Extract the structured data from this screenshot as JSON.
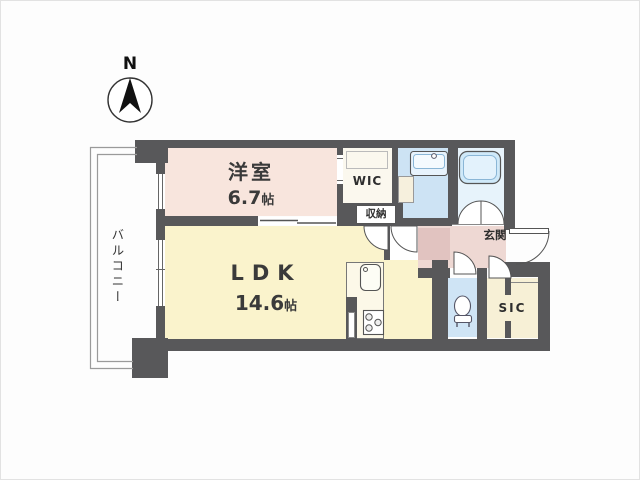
{
  "meta": {
    "document_type": "apartment floor plan",
    "compass_label": "N"
  },
  "rooms": {
    "yoshitsu": {
      "name": "洋室",
      "size_value": "6.7",
      "size_unit": "帖"
    },
    "ldk": {
      "name": "LDK",
      "size_value": "14.6",
      "size_unit": "帖"
    },
    "wic": {
      "label": "WIC"
    },
    "shuno": {
      "label": "収納"
    },
    "genkan": {
      "label": "玄関"
    },
    "sic": {
      "label": "SIC"
    },
    "balcony": {
      "label": "バルコニー"
    }
  },
  "fixtures": [
    "bathtub",
    "washbasin",
    "toilet",
    "kitchen-sink",
    "gas-stove",
    "entrance-door",
    "sliding-window",
    "compass-north-arrow"
  ],
  "colors": {
    "wall": "#58585a",
    "western_room": "#f8e5dd",
    "ldk": "#faf3cc",
    "entrance": "#eed8d3",
    "entrance_step": "#e1c3c0",
    "washroom": "#cde3f4",
    "bathroom": "#e7f3fb",
    "toilet": "#cfe4f5",
    "sic": "#f7f0d6",
    "wic": "#fbf8ee",
    "balcony_line": "#9a9a9a"
  }
}
